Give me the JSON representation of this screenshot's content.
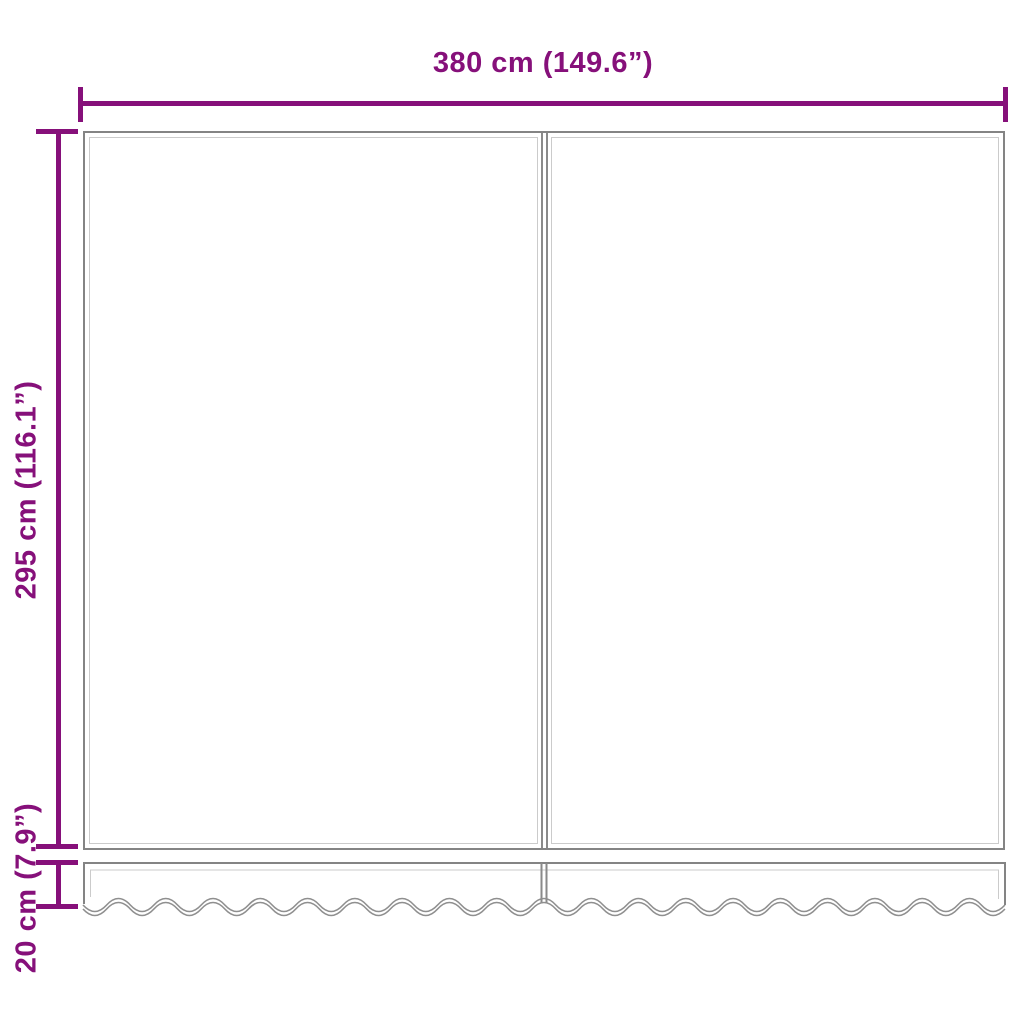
{
  "diagram": {
    "type": "product-dimension-diagram",
    "labels": {
      "width": "380 cm (149.6”)",
      "height": "295 cm (116.1”)",
      "valance_height": "20 cm (7.9”)"
    },
    "colors": {
      "dimension_accent": "#86107A",
      "fabric_outline": "#848484",
      "hem_line": "#cbcbcb",
      "wave_line": "#8f8f8f"
    },
    "wave": {
      "scallop_count": 19.5
    }
  }
}
